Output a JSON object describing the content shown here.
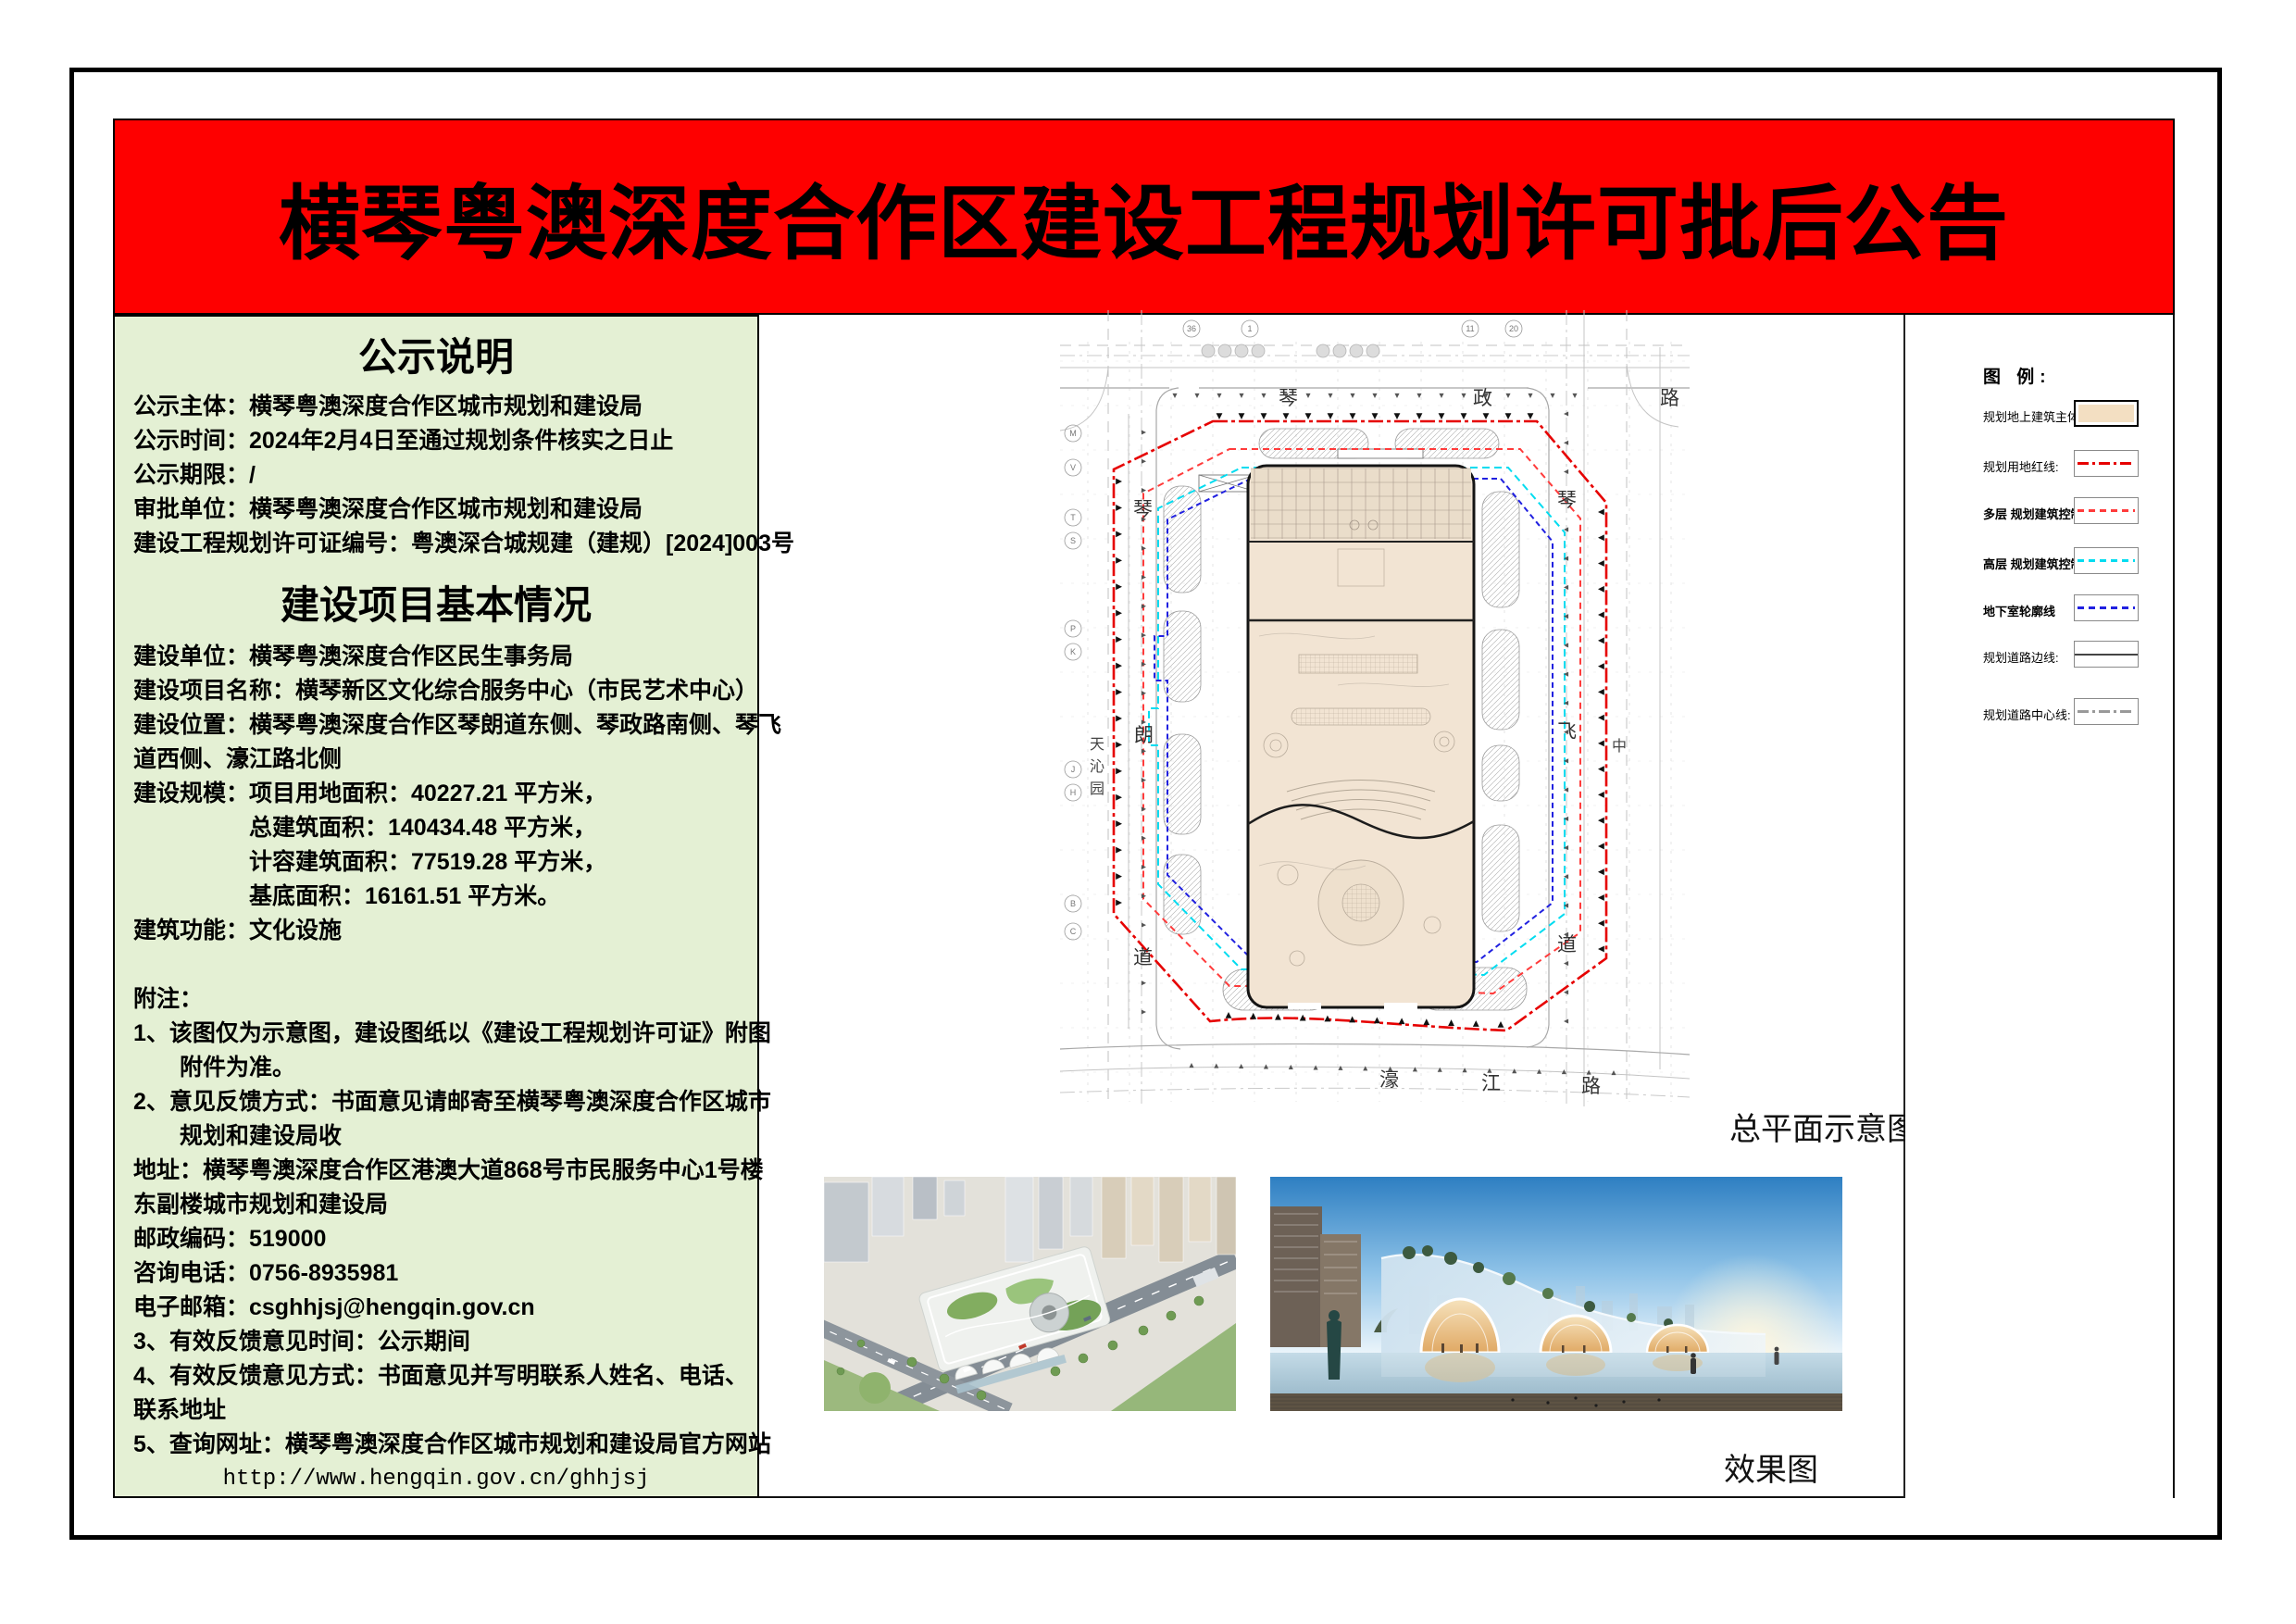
{
  "banner": {
    "title": "横琴粤澳深度合作区建设工程规划许可批后公告"
  },
  "notice": {
    "section1": {
      "title": "公示说明",
      "lines": [
        {
          "t": "公示主体：横琴粤澳深度合作区城市规划和建设局"
        },
        {
          "t": "公示时间：2024年2月4日至通过规划条件核实之日止"
        },
        {
          "t": "公示期限：/"
        },
        {
          "t": "审批单位：横琴粤澳深度合作区城市规划和建设局"
        },
        {
          "t": "建设工程规划许可证编号：粤澳深合城规建（建规）[2024]003号"
        }
      ]
    },
    "section2": {
      "title": "建设项目基本情况",
      "lines": [
        {
          "t": "建设单位：横琴粤澳深度合作区民生事务局"
        },
        {
          "t": "建设项目名称：横琴新区文化综合服务中心（市民艺术中心）"
        },
        {
          "t": "建设位置：横琴粤澳深度合作区琴朗道东侧、琴政路南侧、琴飞"
        },
        {
          "t": "道西侧、濠江路北侧"
        },
        {
          "t": "建设规模：项目用地面积：40227.21 平方米，"
        },
        {
          "t": "总建筑面积：140434.48 平方米，",
          "ind": 1
        },
        {
          "t": "计容建筑面积：77519.28 平方米，",
          "ind": 1
        },
        {
          "t": "基底面积：16161.51 平方米。",
          "ind": 1
        },
        {
          "t": "建筑功能：文化设施"
        },
        {
          "t": ""
        },
        {
          "t": "附注："
        },
        {
          "t": "1、该图仅为示意图，建设图纸以《建设工程规划许可证》附图"
        },
        {
          "t": "附件为准。",
          "ind": 2
        },
        {
          "t": "2、意见反馈方式：书面意见请邮寄至横琴粤澳深度合作区城市"
        },
        {
          "t": "规划和建设局收",
          "ind": 2
        },
        {
          "t": "地址：横琴粤澳深度合作区港澳大道868号市民服务中心1号楼"
        },
        {
          "t": "东副楼城市规划和建设局"
        },
        {
          "t": "邮政编码：519000"
        },
        {
          "t": "咨询电话：0756-8935981"
        },
        {
          "t": "电子邮箱：csghhjsj@hengqin.gov.cn"
        },
        {
          "t": "3、有效反馈意见时间：公示期间"
        },
        {
          "t": "4、有效反馈意见方式：书面意见并写明联系人姓名、电话、"
        },
        {
          "t": "联系地址"
        },
        {
          "t": "5、查询网址：横琴粤澳深度合作区城市规划和建设局官方网站"
        },
        {
          "t": "http://www.hengqin.gov.cn/ghhjsj",
          "align": "center",
          "mono": true
        }
      ]
    }
  },
  "site_plan": {
    "caption": "总平面示意图",
    "roads": {
      "top": [
        "琴",
        "政",
        "路"
      ],
      "bottom": [
        "濠",
        "江",
        "路"
      ],
      "left": [
        "琴",
        "朗",
        "道"
      ],
      "right": [
        "琴",
        "飞",
        "道"
      ],
      "far_left": [
        "天",
        "沁",
        "园"
      ],
      "far_right": [
        "中"
      ]
    },
    "axes": {
      "left": [
        "M",
        "V",
        "T",
        "S",
        "P",
        "K",
        "J",
        "H",
        "B",
        "C"
      ],
      "top": [
        "36",
        "1",
        "11",
        "20"
      ]
    }
  },
  "renders": {
    "caption": "效果图"
  },
  "legend": {
    "title": "图 例:",
    "items": [
      {
        "label": "规划地上建筑主体:",
        "swatch": "building",
        "bold": false
      },
      {
        "label": "规划用地红线:",
        "swatch": "red-dashdot",
        "bold": false
      },
      {
        "label": "多层 规划建筑控制线",
        "swatch": "red-dashed",
        "bold": true
      },
      {
        "label": "高层 规划建筑控制线",
        "swatch": "cyan-dashed",
        "bold": true
      },
      {
        "label": "地下室轮廓线",
        "swatch": "blue-dashed",
        "bold": true
      },
      {
        "label": "规划道路边线:",
        "swatch": "road-edge",
        "bold": false
      },
      {
        "label": "规划道路中心线:",
        "swatch": "road-center",
        "bold": false
      }
    ],
    "colors": {
      "building_fill": "#f3dfc2",
      "red_line": "#e60000",
      "multi_line": "#ff3b3b",
      "high_line": "#00dcf0",
      "basement_line": "#2020e0",
      "center_line": "#999999",
      "banner_red": "#fe0000",
      "panel_green": "#e4f0d4"
    }
  }
}
